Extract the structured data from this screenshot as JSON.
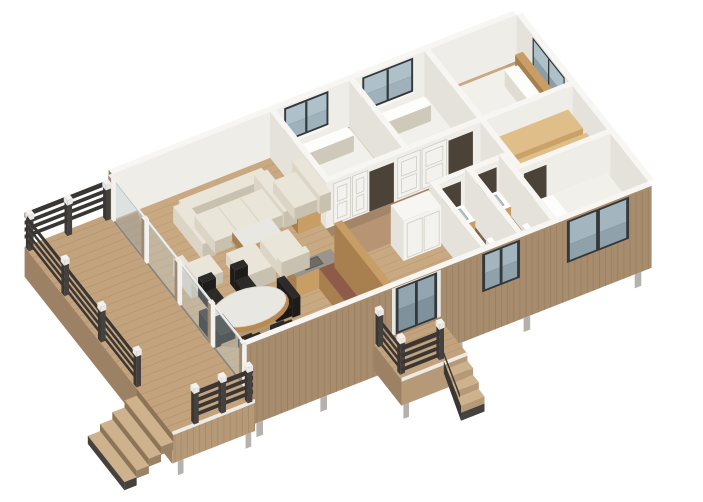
{
  "scene": {
    "description": "Isometric 3D rendering of a single-storey house floor plan: wooden deck with dark railing and steps, open living and dining area behind a glass wall, kitchen, hallway with wardrobe doors, three bedrooms, walk-in closet, two bathrooms and a front entry porch."
  },
  "rooms": [
    {
      "name": "deck"
    },
    {
      "name": "living-room"
    },
    {
      "name": "dining-area"
    },
    {
      "name": "kitchen"
    },
    {
      "name": "entry-hall"
    },
    {
      "name": "hallway"
    },
    {
      "name": "bedroom-1"
    },
    {
      "name": "bedroom-2"
    },
    {
      "name": "master-bedroom"
    },
    {
      "name": "walk-in-closet"
    },
    {
      "name": "bathroom-1"
    },
    {
      "name": "bathroom-2"
    },
    {
      "name": "bedroom-3"
    },
    {
      "name": "front-porch"
    }
  ],
  "colors": {
    "background": "#ffffff",
    "floor": "#c8a982",
    "floor_line": "#b08d66",
    "hall_floor": "#b59272",
    "bath_floor": "#7e6750",
    "bath_floor_line": "#685138",
    "wall_cap": "#f7f6f3",
    "wall_face": "#efede8",
    "wall_face_side": "#e5e2db",
    "wall_end": "#8a7f72",
    "door_opening": "#4b4238",
    "panel_line": "#cfccc4",
    "siding": "#a78c6d",
    "siding_line": "#8f7356",
    "siding_shade": "#96795c",
    "fascia": "#b69a78",
    "fascia_side": "#9c8164",
    "fascia_trim": "#edebe6",
    "deck": "#c3a37d",
    "deck_line": "#a98862",
    "step": "#cdb28d",
    "step_trim": "#45413c",
    "rail": "#393634",
    "rail_side": "#45413d",
    "rail_cap": "#e9e8e4",
    "glass": "#9fb2bc",
    "glass_light": "#aec0c8",
    "glass_dark": "#8b9da7",
    "frame": "#33383b",
    "glass_wall_tint": "rgba(190,205,212,0.35)",
    "footing": "#b5b2ad",
    "sofa": "#eae5d9",
    "sofa_side": "#dcd5c6",
    "sofa_shade": "#c9c1b0",
    "marble": "#e9e7e2",
    "table_wood": "#b98a50",
    "wood": "#c89e66",
    "wood_dark": "#a87f4e",
    "plywood": "#dfbe8a",
    "plywood_side": "#caa268",
    "plywood_dark": "#aa8350",
    "plywood_shadow": "#6f5535",
    "bed_top": "#f2f0ea",
    "bed_side": "#e0dcd2",
    "bed_shade": "#cfc9bc",
    "white": "#fdfdfc",
    "chair_black": "#1d1c1b",
    "chair_black_top": "#2c2b29",
    "counter_red": "#8e5b4b",
    "counter_gray": "#9a948c",
    "sink": "#6f6a66",
    "sink_light": "#b9c2c4",
    "shadow_soft": "rgba(0,0,0,0.10)",
    "shadow_wedge": "rgba(61,47,34,0.45)",
    "shadow_light": "rgba(61,47,34,0.22)"
  }
}
